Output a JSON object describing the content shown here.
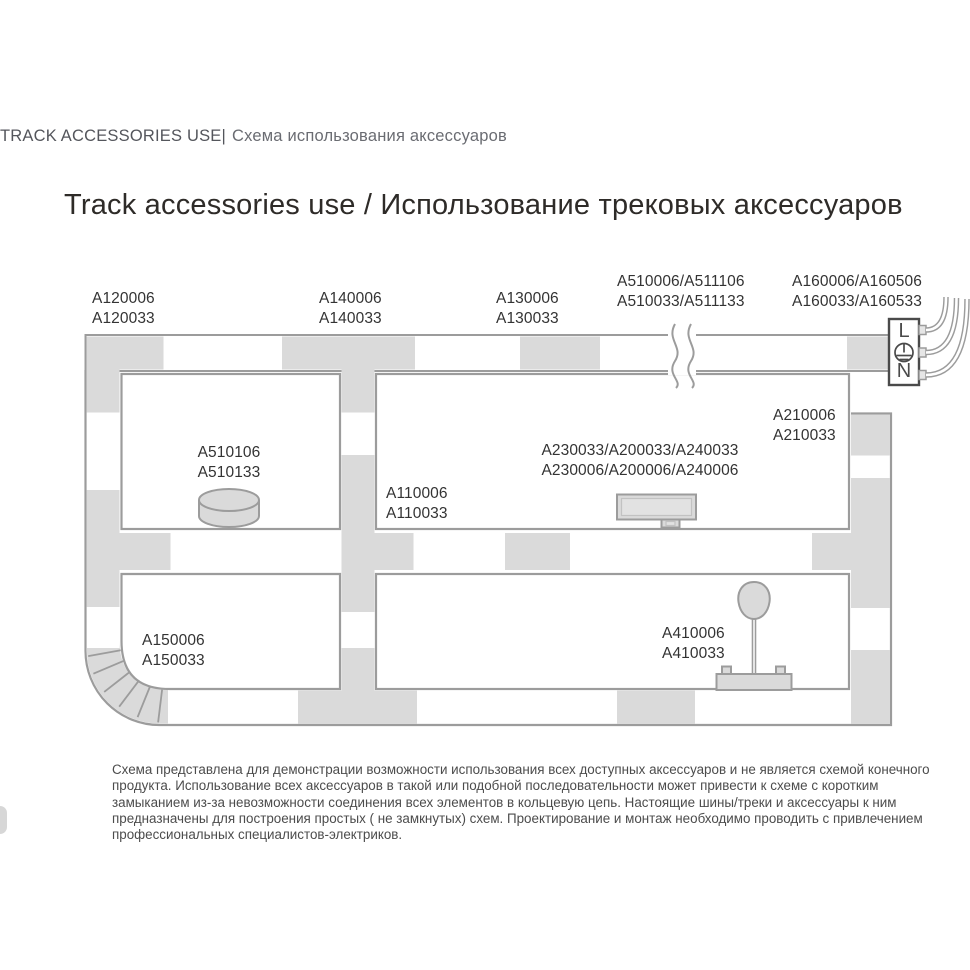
{
  "page": {
    "header": {
      "latin": "TRACK ACCESSORIES USE|",
      "cyrillic": "Схема использования аксессуаров"
    },
    "title": "Track accessories use / Использование трековых аксессуаров",
    "footnote": "Схема представлена для демонстрации возможности использования всех доступных аксессуаров и не является схемой конечного продукта. Использование всех аксессуаров в такой или подобной последовательности может привести к схеме с коротким замыканием из-за невозможности соединения всех элементов в кольцевую цепь. Настоящие шины/треки и аксессуары к ним предназначены для построения простых ( не замкнутых) схем. Проектирование и монтаж необходимо проводить с привлечением профессиональных специалистов-электриков."
  },
  "diagram": {
    "labels": {
      "a120": {
        "l1": "A120006",
        "l2": "A120033"
      },
      "a140": {
        "l1": "A140006",
        "l2": "A140033"
      },
      "a130": {
        "l1": "A130006",
        "l2": "A130033"
      },
      "a510t": {
        "l1": "A510006/A511106",
        "l2": "A510033/A511133"
      },
      "a160": {
        "l1": "A160006/A160506",
        "l2": "A160033/A160533"
      },
      "a210": {
        "l1": "A210006",
        "l2": "A210033"
      },
      "a510106": {
        "l1": "A510106",
        "l2": "A510133"
      },
      "a230": {
        "l1": "A230033/A200033/A240033",
        "l2": "A230006/A200006/A240006"
      },
      "a110": {
        "l1": "A110006",
        "l2": "A110033"
      },
      "a150": {
        "l1": "A150006",
        "l2": "A150033"
      },
      "a410": {
        "l1": "A410006",
        "l2": "A410033"
      }
    },
    "connector_box": {
      "line": "L",
      "neutral": "N",
      "symbol": "earth-ground-icon"
    },
    "icons": {
      "surface_mount": "puck-cylinder-icon",
      "power_feed": "feed-box-icon",
      "pendant": "pendant-adapter-icon",
      "flex_corner": "flexible-corner-icon",
      "break": "wavy-break-icon",
      "wires": "power-wires-icon"
    },
    "colors": {
      "track_fill": "#dadada",
      "track_stroke": "#9c9c9c",
      "box_stroke": "#4a4a4a",
      "label_text": "#333333",
      "title_text": "#2e2b28",
      "header_text": "#54565c",
      "footnote_text": "#4c4c4c"
    }
  }
}
